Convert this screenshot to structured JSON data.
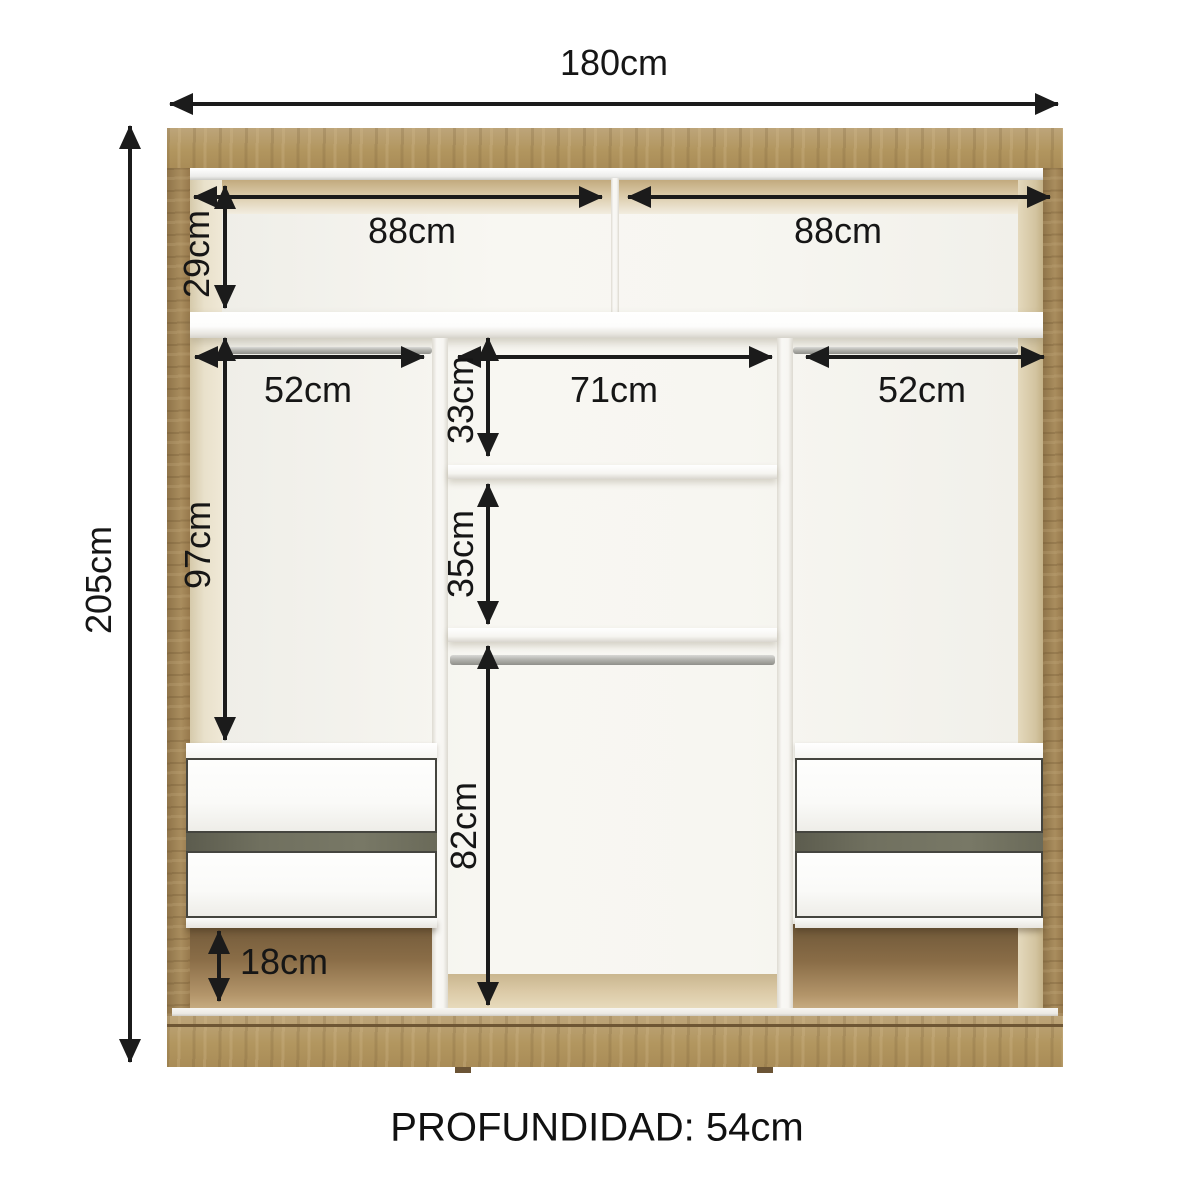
{
  "page": {
    "background": "#ffffff"
  },
  "dimensions": {
    "total_width": "180cm",
    "total_height": "205cm",
    "top_shelf_left_width": "88cm",
    "top_shelf_right_width": "88cm",
    "top_shelf_height": "29cm",
    "left_rod_width": "52cm",
    "center_column_width": "71cm",
    "right_rod_width": "52cm",
    "center_upper_shelf_height": "33cm",
    "center_middle_shelf_height": "35cm",
    "side_hanging_height": "97cm",
    "center_hanging_height": "82cm",
    "base_clearance_height": "18cm"
  },
  "footer": {
    "depth_label": "PROFUNDIDAD: 54cm"
  },
  "colors": {
    "wood": "#b2965f",
    "wood_dark": "#8c7148",
    "inner_face_cream": "#e8dfc8",
    "panel_white": "#f7f6f1",
    "drawer_gap_olive": "#6f705f",
    "metal_rod": "#b3b3ae",
    "dimension_black": "#1b1b1b"
  }
}
